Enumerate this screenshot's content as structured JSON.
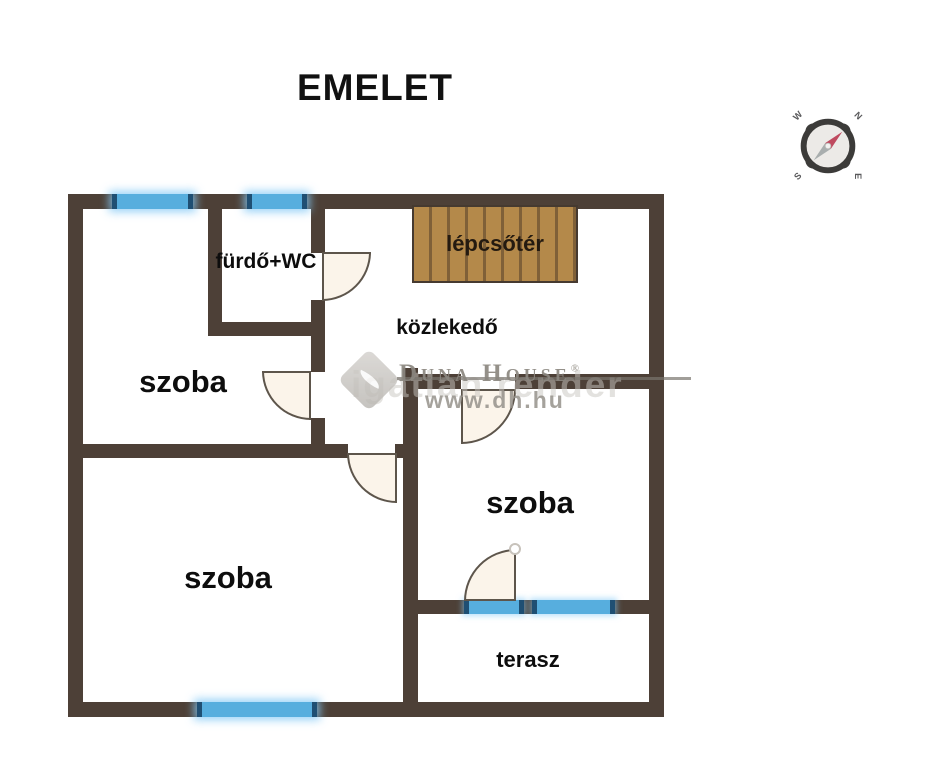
{
  "title": "EMELET",
  "rooms": {
    "furdo": {
      "label": "fürdő+WC"
    },
    "lepcso": {
      "label": "lépcsőtér"
    },
    "kozlekedo": {
      "label": "közlekedő"
    },
    "szoba_felso": {
      "label": "szoba"
    },
    "szoba_jobb": {
      "label": "szoba"
    },
    "szoba_nagy": {
      "label": "szoba"
    },
    "terasz": {
      "label": "terasz"
    }
  },
  "compass": {
    "w": "W",
    "n": "N",
    "s": "S",
    "e": "E"
  },
  "watermark": {
    "brand": "Duna House",
    "registered": "®",
    "url": "www.dh.hu",
    "shadow_text": "igatlan render"
  },
  "colors": {
    "wall": "#4d4037",
    "window": "#57aede",
    "stairs": "#b4894a",
    "door_fill": "#fbf4ea",
    "needle_red": "#bf4a5f",
    "needle_gray": "#a9aeae"
  }
}
